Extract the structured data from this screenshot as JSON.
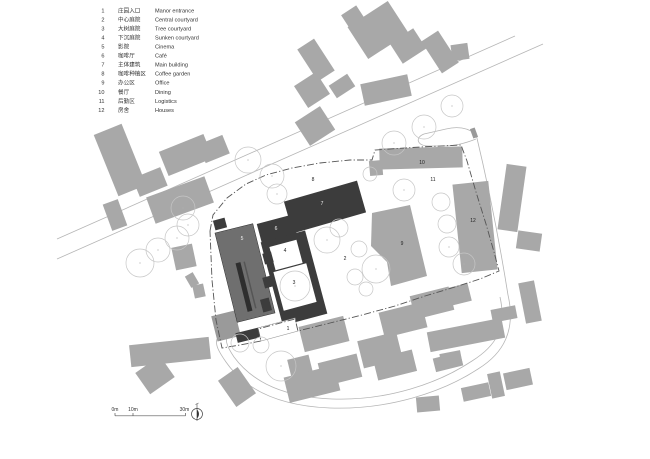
{
  "title": "architectural-site-plan",
  "colors": {
    "background": "#ffffff",
    "context_building": "#a8a8a8",
    "dark_building": "#3c3c3c",
    "cinema_building": "#6f6f6f",
    "cinema_stripe": "#2e2e2e",
    "annex_building": "#9a9a9a",
    "road": "#b5b5b5",
    "tree_outline": "#c6c6c6",
    "boundary": "#555555",
    "text": "#333333",
    "label_light": "#f2f2f2"
  },
  "legend": {
    "items": [
      {
        "no": "1",
        "zh": "庄园入口",
        "en": "Manor entrance"
      },
      {
        "no": "2",
        "zh": "中心庭院",
        "en": "Central courtyard"
      },
      {
        "no": "3",
        "zh": "大树庭院",
        "en": "Tree courtyard"
      },
      {
        "no": "4",
        "zh": "下沉庭院",
        "en": "Sunken courtyard"
      },
      {
        "no": "5",
        "zh": "影院",
        "en": "Cinema"
      },
      {
        "no": "6",
        "zh": "咖啡厅",
        "en": "Café"
      },
      {
        "no": "7",
        "zh": "主体建筑",
        "en": "Main building"
      },
      {
        "no": "8",
        "zh": "咖啡种植区",
        "en": "Coffee garden"
      },
      {
        "no": "9",
        "zh": "办公区",
        "en": "Office"
      },
      {
        "no": "10",
        "zh": "餐厅",
        "en": "Dining"
      },
      {
        "no": "11",
        "zh": "后勤区",
        "en": "Logistics"
      },
      {
        "no": "12",
        "zh": "房舍",
        "en": "Houses"
      }
    ],
    "layout": {
      "x_num": 104.5,
      "x_zh": 118,
      "x_en": 155,
      "y_first": 12.3,
      "row_h": 9.05,
      "font_size": 5.6
    }
  },
  "scale_bar": {
    "labels": [
      {
        "text": "0m",
        "x": 115
      },
      {
        "text": "10m",
        "x": 133
      },
      {
        "text": "30m",
        "x": 184.5
      }
    ],
    "line": {
      "x1": 115,
      "x2": 185.5,
      "y": 415.8
    },
    "ticks": [
      115,
      133,
      185.5
    ],
    "label_y": 411,
    "font_size": 5
  },
  "north_arrow": {
    "cx": 197,
    "cy": 414,
    "r": 5.5
  },
  "plan_labels": [
    {
      "text": "1",
      "x": 288,
      "y": 330,
      "light": false
    },
    {
      "text": "2",
      "x": 345,
      "y": 260,
      "light": false
    },
    {
      "text": "3",
      "x": 294,
      "y": 284,
      "light": false
    },
    {
      "text": "4",
      "x": 285,
      "y": 252,
      "light": false
    },
    {
      "text": "5",
      "x": 242,
      "y": 240,
      "light": true
    },
    {
      "text": "6",
      "x": 276,
      "y": 230,
      "light": true
    },
    {
      "text": "7",
      "x": 322,
      "y": 205,
      "light": true
    },
    {
      "text": "8",
      "x": 313,
      "y": 181,
      "light": false
    },
    {
      "text": "9",
      "x": 402,
      "y": 245,
      "light": false
    },
    {
      "text": "10",
      "x": 422,
      "y": 164,
      "light": false
    },
    {
      "text": "11",
      "x": 433,
      "y": 181,
      "light": false
    },
    {
      "text": "12",
      "x": 473,
      "y": 222,
      "light": false
    }
  ],
  "roads": {
    "main": [
      "M515,36 L57,239",
      "M543,44 L57,259"
    ],
    "loop": [
      "M476,134 C488,184 500,245 508,295",
      "M508,295 C516,330 504,353 478,369 C443,392 389,410 330,408 C281,406 246,391 226,362 C219,352 215,345 217,339",
      "M500,297 C507,328 496,346 472,361 C439,383 388,401 332,399 C286,397 254,384 234,357 C228,348 225,342 227,336",
      "M476,139 C466,143 455,146 444,146 L428,146 C418,146 414,138 424,134 L446,129 C458,126 468,128 476,134"
    ]
  },
  "site_boundary": [
    [
      210,
      231
    ],
    [
      213,
      215
    ],
    [
      227,
      198
    ],
    [
      246,
      184
    ],
    [
      266,
      175
    ],
    [
      292,
      168
    ],
    [
      320,
      163
    ],
    [
      350,
      160
    ],
    [
      372,
      160
    ],
    [
      375,
      150
    ],
    [
      420,
      147
    ],
    [
      461,
      145
    ],
    [
      467,
      161
    ],
    [
      476,
      192
    ],
    [
      486,
      224
    ],
    [
      494,
      252
    ],
    [
      499,
      271
    ],
    [
      480,
      279
    ],
    [
      455,
      287
    ],
    [
      425,
      296
    ],
    [
      395,
      306
    ],
    [
      362,
      315
    ],
    [
      330,
      323
    ],
    [
      298,
      331
    ],
    [
      295,
      319
    ],
    [
      258,
      329
    ],
    [
      261,
      341
    ],
    [
      240,
      345
    ],
    [
      222,
      348
    ],
    [
      216,
      320
    ],
    [
      212,
      280
    ],
    [
      210,
      231
    ]
  ],
  "context_buildings": [
    [
      120,
      160,
      30,
      66,
      -22
    ],
    [
      150,
      182,
      30,
      20,
      -22
    ],
    [
      186,
      155,
      48,
      26,
      -22
    ],
    [
      214,
      149,
      26,
      20,
      -22
    ],
    [
      180,
      200,
      62,
      28,
      -20
    ],
    [
      115,
      215,
      16,
      28,
      -20
    ],
    [
      378,
      30,
      48,
      38,
      -33
    ],
    [
      408,
      46,
      28,
      24,
      -33
    ],
    [
      353,
      17,
      18,
      16,
      -33
    ],
    [
      440,
      52,
      20,
      38,
      -33
    ],
    [
      460,
      52,
      17,
      16,
      -8
    ],
    [
      316,
      60,
      20,
      38,
      -33
    ],
    [
      312,
      90,
      26,
      26,
      -33
    ],
    [
      342,
      86,
      22,
      15,
      -33
    ],
    [
      386,
      90,
      48,
      22,
      -12
    ],
    [
      315,
      126,
      30,
      28,
      -33
    ],
    [
      184,
      257,
      21,
      23,
      -12
    ],
    [
      192,
      280,
      9,
      13,
      -30
    ],
    [
      199,
      291,
      11,
      13,
      -12
    ],
    [
      170,
      352,
      80,
      22,
      -6
    ],
    [
      155,
      375,
      30,
      26,
      -35
    ],
    [
      237,
      387,
      24,
      32,
      -35
    ],
    [
      300,
      366,
      22,
      18,
      -14
    ],
    [
      312,
      384,
      52,
      26,
      -14
    ],
    [
      340,
      370,
      40,
      24,
      -14
    ],
    [
      324,
      334,
      46,
      26,
      -14
    ],
    [
      380,
      350,
      40,
      28,
      -14
    ],
    [
      403,
      320,
      44,
      26,
      -14
    ],
    [
      432,
      303,
      40,
      24,
      -14
    ],
    [
      457,
      295,
      26,
      18,
      -14
    ],
    [
      395,
      365,
      40,
      22,
      -14
    ],
    [
      448,
      362,
      28,
      14,
      -14
    ],
    [
      428,
      404,
      23,
      15,
      -5
    ],
    [
      476,
      392,
      28,
      14,
      -12
    ],
    [
      496,
      385,
      13,
      25,
      -12
    ],
    [
      518,
      379,
      27,
      17,
      -12
    ],
    [
      466,
      335,
      76,
      20,
      -11
    ],
    [
      451,
      359,
      21,
      14,
      -11
    ],
    [
      530,
      302,
      16,
      41,
      -11
    ],
    [
      504,
      314,
      25,
      13,
      -11
    ],
    [
      512,
      198,
      20,
      66,
      8
    ],
    [
      529,
      241,
      24,
      18,
      8
    ]
  ],
  "site_buildings": {
    "dining_10": [
      421,
      158,
      83,
      21,
      -1.5
    ],
    "dining_10_annex": [
      376,
      168,
      13,
      15,
      -5
    ],
    "houses_12": [
      475,
      227,
      36,
      89,
      -6
    ],
    "office_9_polygon": [
      [
        372,
        213
      ],
      [
        410,
        205
      ],
      [
        427,
        276
      ],
      [
        391,
        286
      ],
      [
        387,
        262
      ],
      [
        371,
        246
      ]
    ],
    "gate_tick": [
      474,
      133,
      5,
      10,
      -20
    ]
  },
  "main_complex": {
    "cinema_5": [
      245,
      273,
      39,
      92,
      -14
    ],
    "cinema_stripe": [
      244,
      287,
      5,
      50,
      -14
    ],
    "cinema_stripe2": [
      250,
      285,
      1.5,
      48,
      -14
    ],
    "cinema_top_block": [
      220,
      224,
      12,
      10,
      -15
    ],
    "annex": [
      226,
      326,
      24,
      26,
      -14
    ],
    "bottom_bar": [
      257,
      333,
      42,
      10,
      -14
    ],
    "main_bar_7": [
      325,
      207,
      76,
      33,
      -16
    ],
    "cafe_6": [
      277,
      230,
      36,
      22,
      -15
    ],
    "courtyard_frame": [
      294,
      278,
      46,
      86,
      -15
    ],
    "sunken_courtyard_4": [
      286,
      255,
      28,
      24,
      -15
    ],
    "tree_courtyard_3": [
      295,
      287,
      34,
      40,
      -15
    ],
    "tabs": [
      [
        268,
        258,
        9,
        11,
        -15
      ],
      [
        268,
        282,
        9,
        11,
        -15
      ],
      [
        266,
        305,
        9,
        13,
        -15
      ]
    ],
    "entrance_plaza": [
      [
        258,
        328
      ],
      [
        295,
        318
      ],
      [
        298,
        331
      ],
      [
        261,
        341
      ]
    ]
  },
  "trees": [
    [
      140,
      263,
      14
    ],
    [
      158,
      250,
      12
    ],
    [
      177,
      238,
      12
    ],
    [
      188,
      225,
      11
    ],
    [
      183,
      208,
      12
    ],
    [
      394,
      143,
      12
    ],
    [
      424,
      127,
      12
    ],
    [
      452,
      106,
      11
    ],
    [
      248,
      160,
      13
    ],
    [
      272,
      176,
      12
    ],
    [
      277,
      194,
      10
    ],
    [
      327,
      240,
      13
    ],
    [
      339,
      228,
      9
    ],
    [
      359,
      249,
      8
    ],
    [
      376,
      269,
      14
    ],
    [
      355,
      277,
      8
    ],
    [
      366,
      289,
      7
    ],
    [
      295,
      286,
      15
    ],
    [
      441,
      202,
      9
    ],
    [
      447,
      224,
      9
    ],
    [
      449,
      247,
      10
    ],
    [
      464,
      264,
      11
    ],
    [
      404,
      190,
      11
    ],
    [
      370,
      174,
      7
    ],
    [
      240,
      343,
      9
    ],
    [
      261,
      345,
      8
    ],
    [
      281,
      366,
      15
    ]
  ]
}
